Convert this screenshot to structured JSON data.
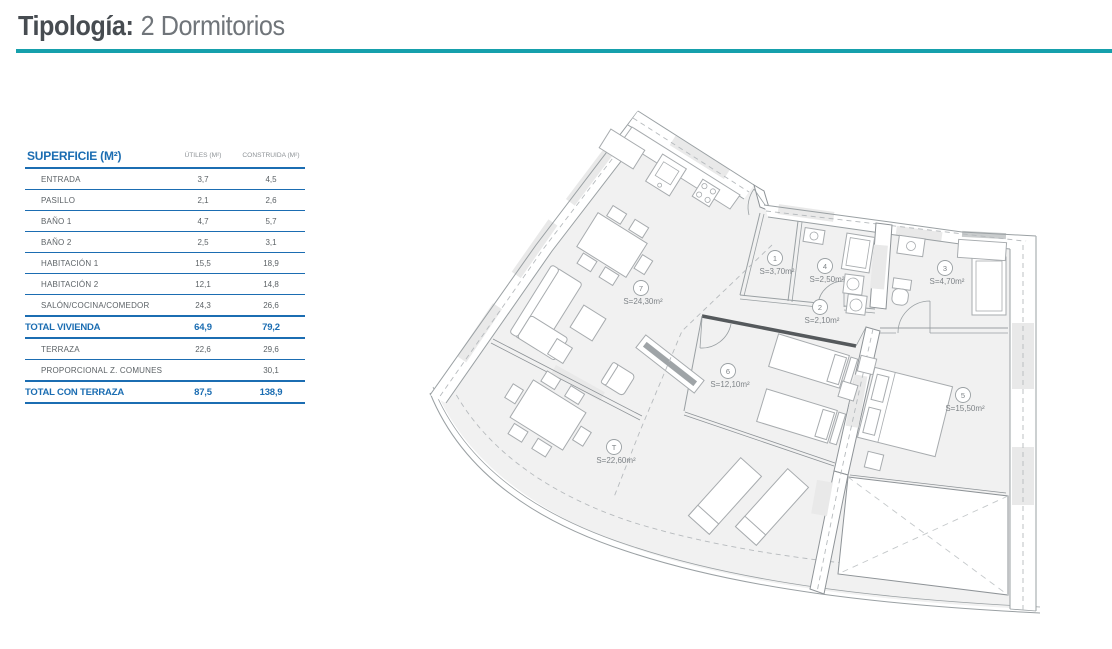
{
  "page": {
    "title_label": "Tipología:",
    "title_value": "2 Dormitorios"
  },
  "colors": {
    "accent_teal": "#16a0ac",
    "accent_blue": "#1b6db2",
    "title_dark": "#474c51",
    "title_light": "#70757a"
  },
  "surface_table": {
    "title": "SUPERFICIE (M²)",
    "columns": [
      "ÚTILES (M²)",
      "CONSTRUIDA (M²)"
    ],
    "rows": [
      {
        "label": "ENTRADA",
        "utiles": "3,7",
        "construida": "4,5",
        "total": false
      },
      {
        "label": "PASILLO",
        "utiles": "2,1",
        "construida": "2,6",
        "total": false
      },
      {
        "label": "BAÑO 1",
        "utiles": "4,7",
        "construida": "5,7",
        "total": false
      },
      {
        "label": "BAÑO 2",
        "utiles": "2,5",
        "construida": "3,1",
        "total": false
      },
      {
        "label": "HABITACIÓN 1",
        "utiles": "15,5",
        "construida": "18,9",
        "total": false
      },
      {
        "label": "HABITACIÓN 2",
        "utiles": "12,1",
        "construida": "14,8",
        "total": false
      },
      {
        "label": "SALÓN/COCINA/COMEDOR",
        "utiles": "24,3",
        "construida": "26,6",
        "total": false
      },
      {
        "label": "TOTAL VIVIENDA",
        "utiles": "64,9",
        "construida": "79,2",
        "total": true
      },
      {
        "label": "TERRAZA",
        "utiles": "22,6",
        "construida": "29,6",
        "total": false
      },
      {
        "label": "PROPORCIONAL Z. COMUNES",
        "utiles": "",
        "construida": "30,1",
        "total": false
      },
      {
        "label": "TOTAL CON TERRAZA",
        "utiles": "87,5",
        "construida": "138,9",
        "total": true
      }
    ]
  },
  "floor_plan": {
    "rooms": [
      {
        "id": "7",
        "area": "S=24,30m²"
      },
      {
        "id": "1",
        "area": "S=3,70m²"
      },
      {
        "id": "4",
        "area": "S=2,50m²"
      },
      {
        "id": "3",
        "area": "S=4,70m²"
      },
      {
        "id": "2",
        "area": "S=2,10m²"
      },
      {
        "id": "6",
        "area": "S=12,10m²"
      },
      {
        "id": "5",
        "area": "S=15,50m²"
      },
      {
        "id": "T",
        "area": "S=22,60m²"
      }
    ]
  }
}
